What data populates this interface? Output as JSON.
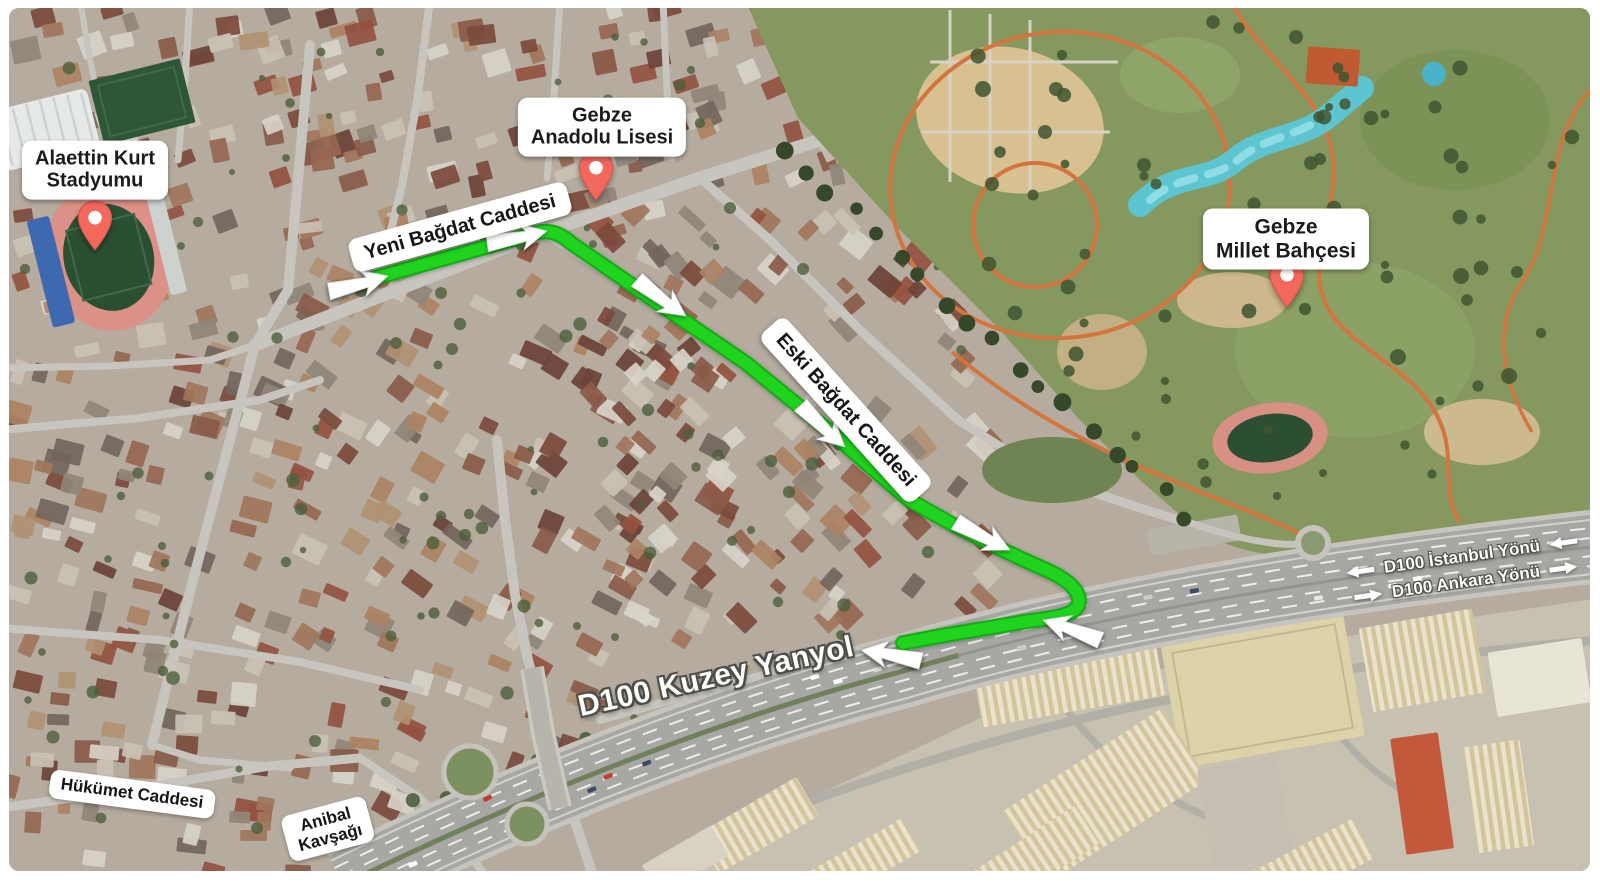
{
  "pois": [
    {
      "id": "alaettin-kurt-stadyumu",
      "line1": "Alaettin Kurt",
      "line2": "Stadyumu"
    },
    {
      "id": "gebze-anadolu-lisesi",
      "line1": "Gebze",
      "line2": "Anadolu Lisesi"
    },
    {
      "id": "gebze-millet-bahcesi",
      "line1": "Gebze",
      "line2": "Millet Bahçesi"
    }
  ],
  "street_labels": {
    "yeni_bagdat": "Yeni Bağdat Caddesi",
    "eski_bagdat": "Eski Bağdat Caddesi",
    "hukumet": "Hükümet Caddesi",
    "anibal": {
      "line1": "Anibal",
      "line2": "Kavşağı"
    },
    "d100_kuzey": "D100 Kuzey Yanyol",
    "d100_istanbul": "D100 İstanbul Yönü",
    "d100_ankara": "D100 Ankara Yönü"
  },
  "route": {
    "color": "#1fd31f",
    "casing_color": "#12ad12",
    "path": "M375,278 L536,233 C550,229 561,234 571,243 L642,292 L746,363 L833,434 L908,499 C945,521 992,546 1042,568 C1066,578 1080,590 1079,602 C1078,614 1057,618 1029,621 L940,636 L903,643",
    "arrows": [
      {
        "x": 388,
        "y": 276,
        "deg": -17
      },
      {
        "x": 547,
        "y": 231,
        "deg": -14
      },
      {
        "x": 686,
        "y": 316,
        "deg": 34
      },
      {
        "x": 845,
        "y": 447,
        "deg": 41
      },
      {
        "x": 1010,
        "y": 550,
        "deg": 25
      },
      {
        "x": 1043,
        "y": 620,
        "deg": 197
      },
      {
        "x": 861,
        "y": 650,
        "deg": 188
      }
    ]
  },
  "markers": {
    "pin_color": "#f2685c",
    "pin_border": "#d6544a",
    "pin_dot": "#ffffff"
  },
  "colors": {
    "label_bg": "#ffffff",
    "label_text": "#1b1b1b",
    "highway_text": "#fdfdfa"
  }
}
